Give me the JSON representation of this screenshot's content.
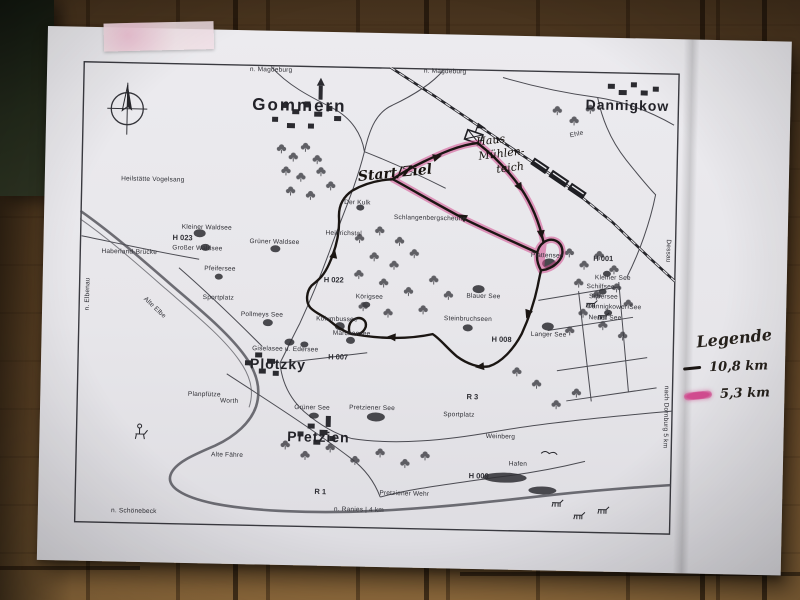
{
  "legend": {
    "title": "Legende",
    "items": [
      {
        "swatch": "black-line",
        "label": "10,8 km"
      },
      {
        "swatch": "pink-marker",
        "label": "5,3 km"
      }
    ]
  },
  "map_labels": [
    {
      "text": "n. Magdeburg",
      "x": 188,
      "y": 6,
      "cls": "tiny"
    },
    {
      "text": "n. Magdeburg",
      "x": 362,
      "y": 4,
      "cls": "tiny"
    },
    {
      "text": "Gommern",
      "x": 217,
      "y": 40,
      "cls": "townlg"
    },
    {
      "text": "Dannigkow",
      "x": 545,
      "y": 33,
      "cls": "town"
    },
    {
      "text": "Ehle",
      "x": 495,
      "y": 64,
      "cls": "tiny",
      "rot": -14
    },
    {
      "text": "Haus",
      "x": 409,
      "y": 71,
      "cls": "hand",
      "rot": -8
    },
    {
      "text": "Mühlen-",
      "x": 420,
      "y": 84,
      "cls": "hand",
      "rot": -8
    },
    {
      "text": "teich",
      "x": 429,
      "y": 98,
      "cls": "hand",
      "rot": -8
    },
    {
      "text": "Start/Ziel",
      "x": 314,
      "y": 106,
      "cls": "handlg",
      "rot": -7
    },
    {
      "text": "Der Kulk",
      "x": 277,
      "y": 137,
      "cls": "tiny"
    },
    {
      "text": "Schlangenbergscheune",
      "x": 350,
      "y": 151,
      "cls": "tiny"
    },
    {
      "text": "Heinrichstal",
      "x": 264,
      "y": 168,
      "cls": "tiny"
    },
    {
      "text": "Heilstätte Vogelsang",
      "x": 72,
      "y": 118,
      "cls": "tiny"
    },
    {
      "text": "Kleiner Waldsee",
      "x": 127,
      "y": 165,
      "cls": "tiny"
    },
    {
      "text": "H 023",
      "x": 103,
      "y": 175,
      "cls": "hmark"
    },
    {
      "text": "Großer Waldsee",
      "x": 118,
      "y": 186,
      "cls": "tiny"
    },
    {
      "text": "Grüner Waldsee",
      "x": 195,
      "y": 178,
      "cls": "tiny"
    },
    {
      "text": "Pfeifersee",
      "x": 141,
      "y": 206,
      "cls": "tiny"
    },
    {
      "text": "Sportplatz",
      "x": 140,
      "y": 235,
      "cls": "tiny"
    },
    {
      "text": "Haberland-Brücke",
      "x": 50,
      "y": 191,
      "cls": "tiny"
    },
    {
      "text": "n. Elbenau",
      "x": 10,
      "y": 233,
      "cls": "tiny",
      "rot": -90
    },
    {
      "text": "Alte Elbe",
      "x": 76,
      "y": 246,
      "cls": "tiny",
      "rot": 42
    },
    {
      "text": "H 022",
      "x": 255,
      "y": 214,
      "cls": "hmark"
    },
    {
      "text": "Körigsee",
      "x": 291,
      "y": 231,
      "cls": "tiny"
    },
    {
      "text": "Pollmeys See",
      "x": 184,
      "y": 251,
      "cls": "tiny"
    },
    {
      "text": "Kolumbussee",
      "x": 259,
      "y": 254,
      "cls": "tiny"
    },
    {
      "text": "Märchensee",
      "x": 274,
      "y": 268,
      "cls": "tiny"
    },
    {
      "text": "Giselasee u. Edersee",
      "x": 208,
      "y": 285,
      "cls": "tiny"
    },
    {
      "text": "H 007",
      "x": 261,
      "y": 291,
      "cls": "hmark"
    },
    {
      "text": "Plötzky",
      "x": 201,
      "y": 299,
      "cls": "town"
    },
    {
      "text": "Blauer See",
      "x": 405,
      "y": 228,
      "cls": "tiny"
    },
    {
      "text": "Steinbruchseen",
      "x": 390,
      "y": 251,
      "cls": "tiny"
    },
    {
      "text": "H 008",
      "x": 424,
      "y": 270,
      "cls": "hmark"
    },
    {
      "text": "Langer See",
      "x": 471,
      "y": 265,
      "cls": "tiny"
    },
    {
      "text": "Plattensee",
      "x": 468,
      "y": 186,
      "cls": "tiny"
    },
    {
      "text": "H 001",
      "x": 524,
      "y": 187,
      "cls": "hmark"
    },
    {
      "text": "Kleiner See",
      "x": 534,
      "y": 207,
      "cls": "tiny"
    },
    {
      "text": "Schilfsee",
      "x": 522,
      "y": 216,
      "cls": "tiny"
    },
    {
      "text": "Silbersee",
      "x": 525,
      "y": 226,
      "cls": "tiny"
    },
    {
      "text": "Dannigkower See",
      "x": 536,
      "y": 236,
      "cls": "tiny"
    },
    {
      "text": "Neuer See",
      "x": 527,
      "y": 247,
      "cls": "tiny"
    },
    {
      "text": "Dessau",
      "x": 588,
      "y": 178,
      "cls": "tiny",
      "rot": 90
    },
    {
      "text": "nach Dornburg 5 km",
      "x": 589,
      "y": 344,
      "cls": "tiny",
      "rot": 90
    },
    {
      "text": "R 3",
      "x": 396,
      "y": 328,
      "cls": "hmark"
    },
    {
      "text": "Sportplatz",
      "x": 383,
      "y": 347,
      "cls": "tiny"
    },
    {
      "text": "Pretziener See",
      "x": 296,
      "y": 342,
      "cls": "tiny"
    },
    {
      "text": "Grüner See",
      "x": 236,
      "y": 343,
      "cls": "tiny"
    },
    {
      "text": "Pretzien",
      "x": 243,
      "y": 371,
      "cls": "town"
    },
    {
      "text": "Planpfütze",
      "x": 128,
      "y": 332,
      "cls": "tiny"
    },
    {
      "text": "Worth",
      "x": 153,
      "y": 338,
      "cls": "tiny"
    },
    {
      "text": "Alte Fähre",
      "x": 152,
      "y": 392,
      "cls": "tiny"
    },
    {
      "text": "n. Schönebeck",
      "x": 60,
      "y": 450,
      "cls": "tiny"
    },
    {
      "text": "n. Ranies | 4 km",
      "x": 285,
      "y": 444,
      "cls": "tiny"
    },
    {
      "text": "Pretziener Wehr",
      "x": 330,
      "y": 427,
      "cls": "tiny"
    },
    {
      "text": "R 1",
      "x": 246,
      "y": 426,
      "cls": "hmark"
    },
    {
      "text": "Weinberg",
      "x": 425,
      "y": 368,
      "cls": "tiny"
    },
    {
      "text": "Hafen",
      "x": 443,
      "y": 395,
      "cls": "tiny"
    },
    {
      "text": "H 009",
      "x": 404,
      "y": 407,
      "cls": "hmark"
    }
  ],
  "colors": {
    "route_black": "#1b1613",
    "route_highlight": "#d14b8f",
    "map_ink": "#3a3a40",
    "paper": "#eae9ed",
    "wood": "#6f5130",
    "tape": "#f0e2e4"
  }
}
